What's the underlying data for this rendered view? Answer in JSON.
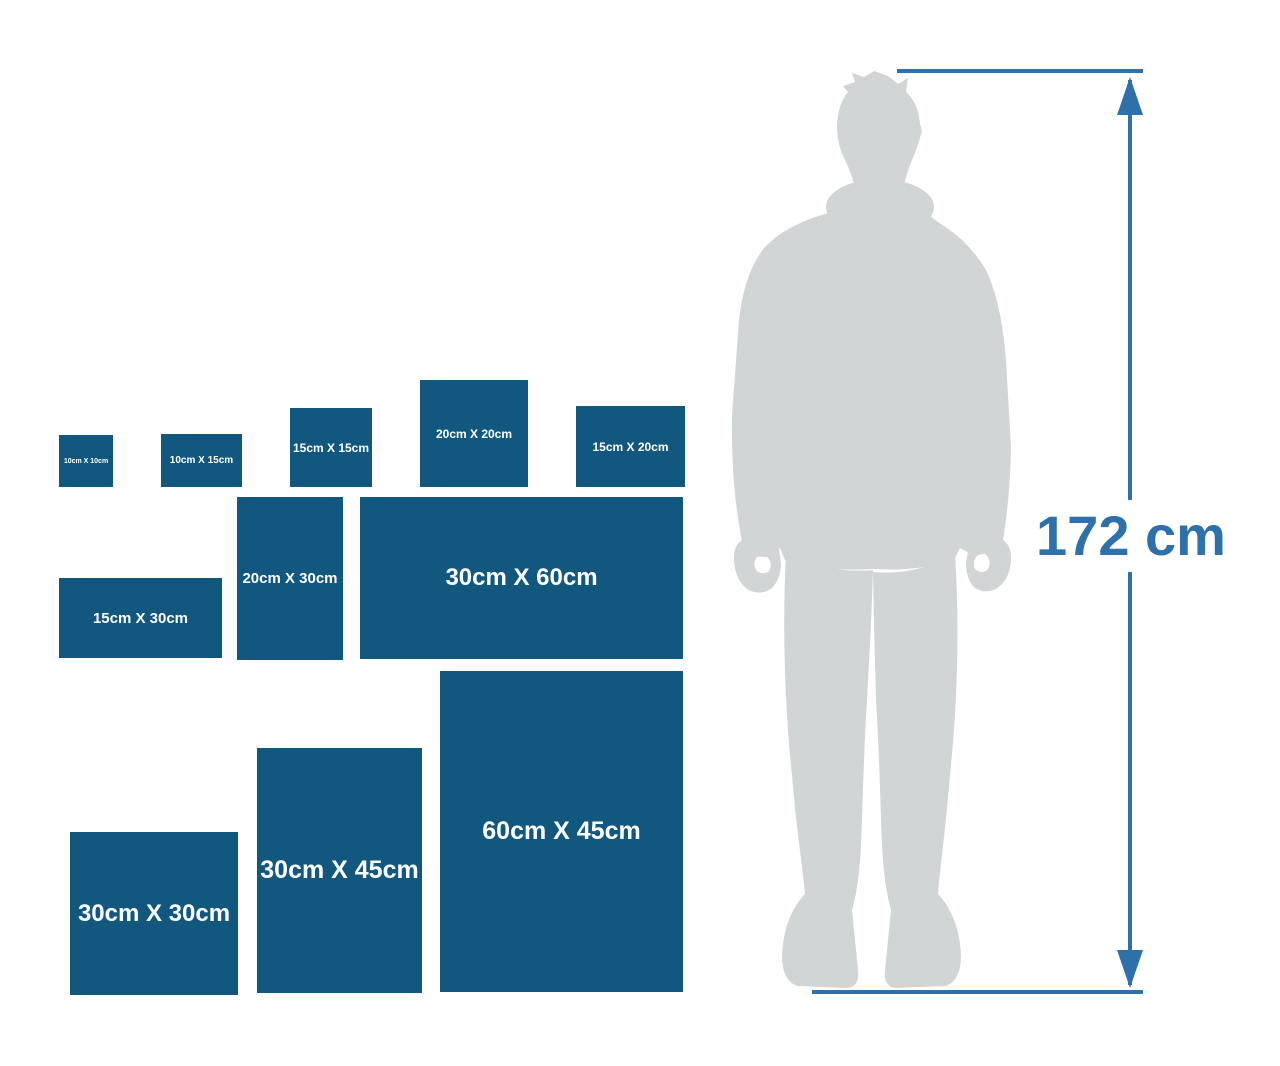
{
  "canvas": {
    "width": 1280,
    "height": 1066
  },
  "colors": {
    "box_blue": "#12587e",
    "accent_blue": "#2e70a9",
    "silhouette_gray": "#d2d5d6",
    "label_white": "#ffffff",
    "background": "#ffffff"
  },
  "size_boxes": [
    {
      "label": "10cm X 10cm",
      "x": 59,
      "y": 435,
      "w": 54,
      "h": 52,
      "font_size": 7
    },
    {
      "label": "10cm X 15cm",
      "x": 161,
      "y": 434,
      "w": 81,
      "h": 53,
      "font_size": 10
    },
    {
      "label": "15cm X 15cm",
      "x": 290,
      "y": 408,
      "w": 82,
      "h": 79,
      "font_size": 12
    },
    {
      "label": "20cm X 20cm",
      "x": 420,
      "y": 380,
      "w": 108,
      "h": 107,
      "font_size": 12
    },
    {
      "label": "15cm X 20cm",
      "x": 576,
      "y": 406,
      "w": 109,
      "h": 81,
      "font_size": 12
    },
    {
      "label": "15cm X 30cm",
      "x": 59,
      "y": 578,
      "w": 163,
      "h": 80,
      "font_size": 15
    },
    {
      "label": "20cm X 30cm",
      "x": 237,
      "y": 497,
      "w": 106,
      "h": 163,
      "font_size": 15
    },
    {
      "label": "30cm X 60cm",
      "x": 360,
      "y": 497,
      "w": 323,
      "h": 162,
      "font_size": 24
    },
    {
      "label": "30cm X 30cm",
      "x": 70,
      "y": 832,
      "w": 168,
      "h": 163,
      "font_size": 24
    },
    {
      "label": "30cm X 45cm",
      "x": 257,
      "y": 748,
      "w": 165,
      "h": 245,
      "font_size": 25
    },
    {
      "label": "60cm X 45cm",
      "x": 440,
      "y": 671,
      "w": 243,
      "h": 321,
      "font_size": 25
    }
  ],
  "dimension": {
    "label": "172 cm"
  }
}
